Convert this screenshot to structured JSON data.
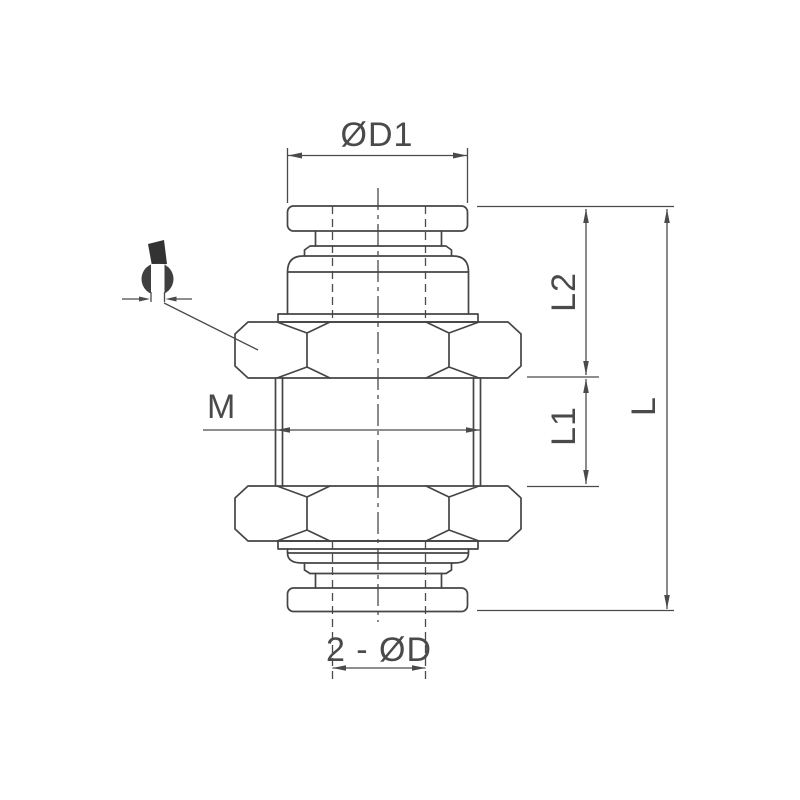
{
  "drawing": {
    "title": "push-in-bulkhead-union-fitting-dimension-drawing",
    "labels": {
      "d1": "ØD1",
      "m": "M",
      "l2": "L2",
      "l1": "L1",
      "l": "L",
      "d": "2 - ØD"
    },
    "icons": [
      {
        "name": "wrench-icon",
        "meaning": "spanner flats (wrench size) indicator"
      }
    ],
    "colors": {
      "line": "#454545",
      "dimension": "#4a4a4a",
      "icon_fill": "#3a3a3a",
      "background": "#ffffff"
    }
  }
}
